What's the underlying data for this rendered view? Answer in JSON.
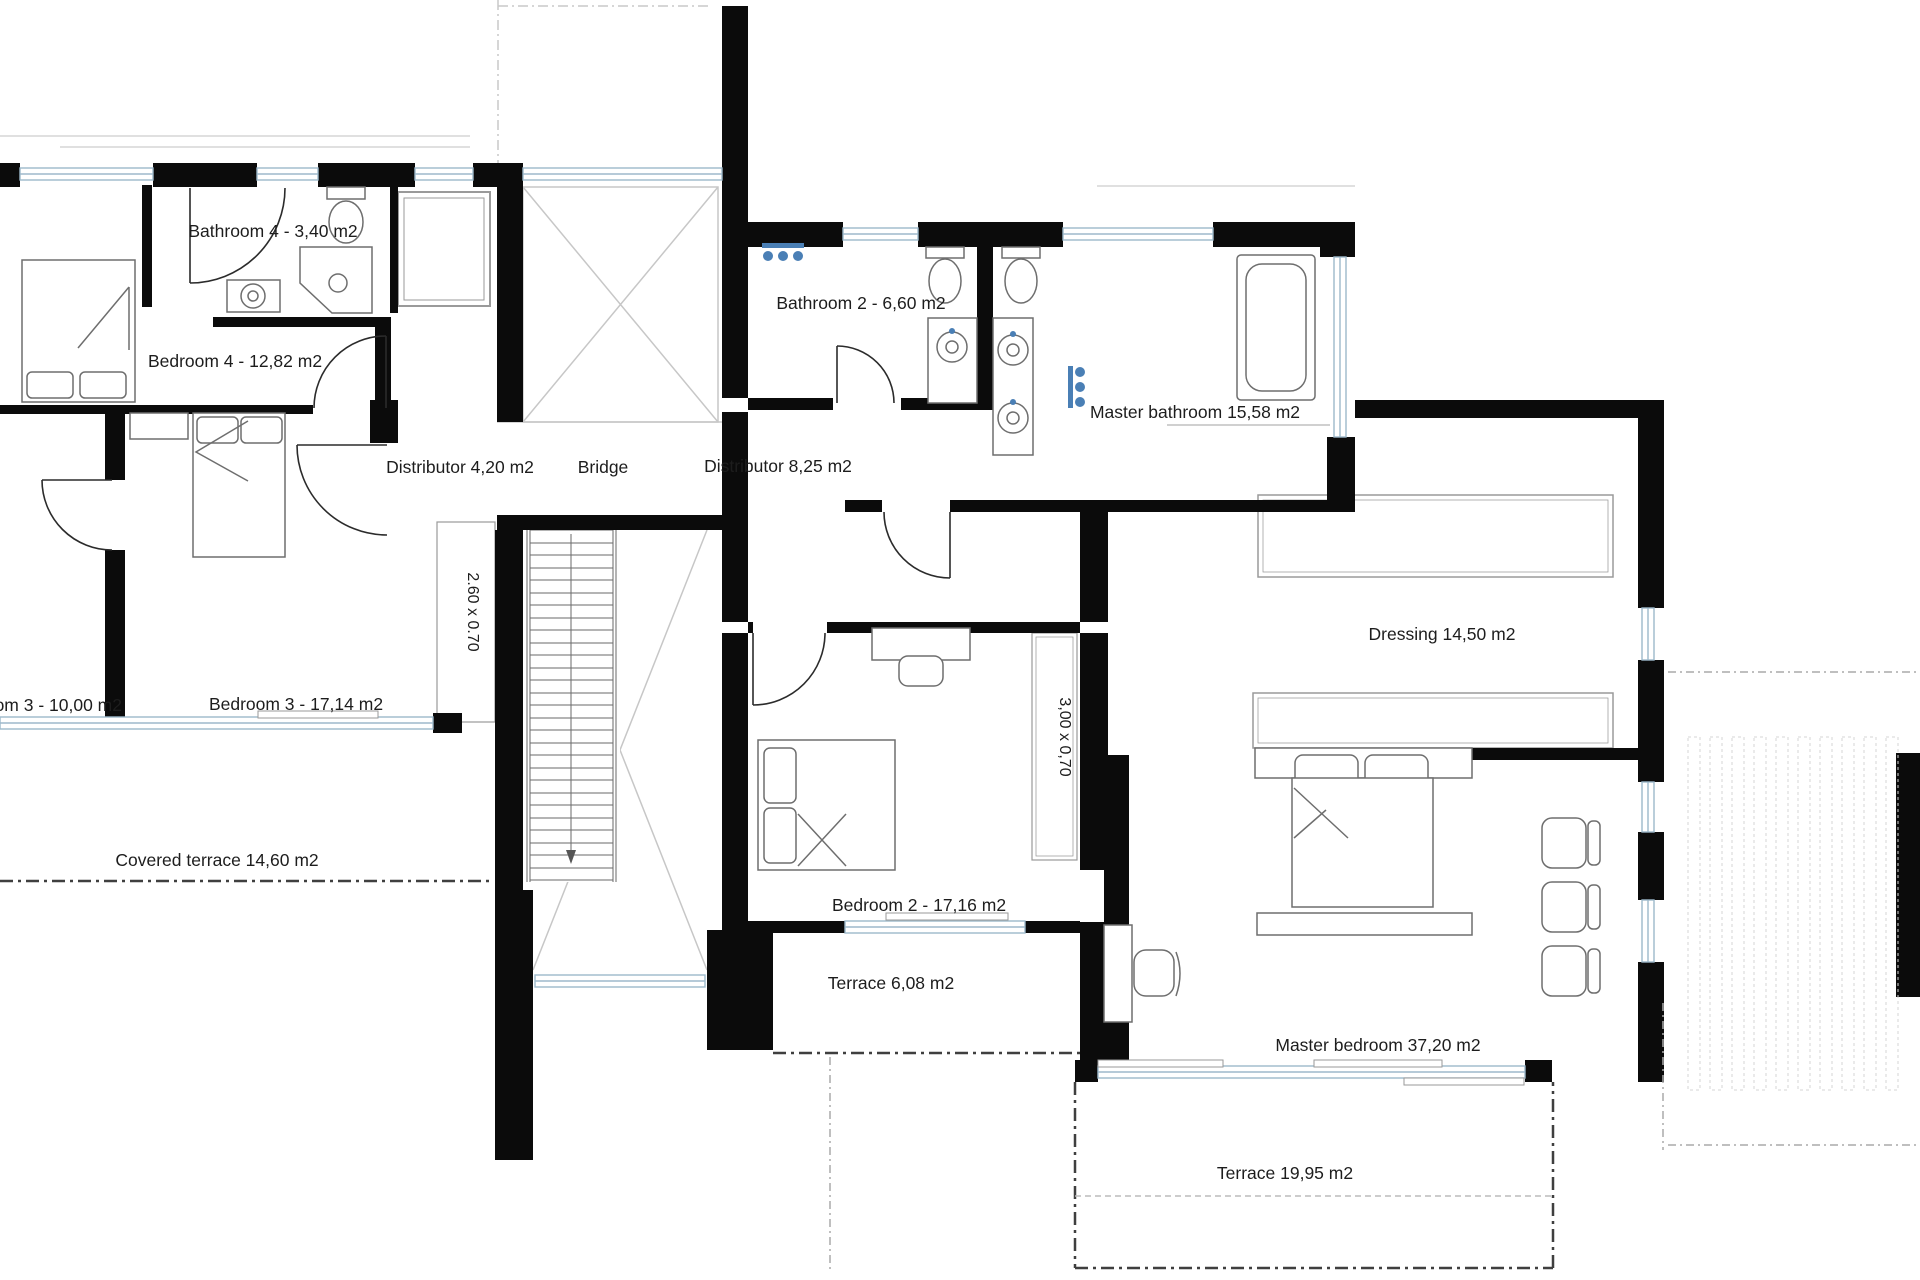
{
  "colors": {
    "wall": "#0b0b0b",
    "window_frame": "#9db9cb",
    "furniture": "#6e6e6e",
    "fixture_accent": "#4a7fb5",
    "text": "#1d1d1d",
    "void_line": "#c9c9c9",
    "terrace_dash": "#3f3f3f"
  },
  "labels": {
    "bathroom4": "Bathroom 4 -  3,40 m2",
    "bedroom4": "Bedroom 4 - 12,82 m2",
    "bathroom2": "Bathroom 2 - 6,60 m2",
    "master_bathroom": "Master bathroom 15,58 m2",
    "distributor_4": "Distributor 4,20 m2",
    "bridge": "Bridge",
    "distributor_8": "Distributor 8,25 m2",
    "dressing": "Dressing 14,50 m2",
    "bathroom3": "Bathroom 3 -  10,00 m2",
    "bedroom3": "Bedroom 3 -  17,14 m2",
    "covered_terrace": "Covered terrace 14,60 m2",
    "bedroom2": "Bedroom 2 - 17,16 m2",
    "terrace_small": "Terrace 6,08 m2",
    "master_bedroom": "Master bedroom 37,20 m2",
    "terrace_large": "Terrace 19,95 m2",
    "closet_stair": "2.60 x 0.70",
    "closet_bedroom2": "3,00 x 0,70"
  }
}
